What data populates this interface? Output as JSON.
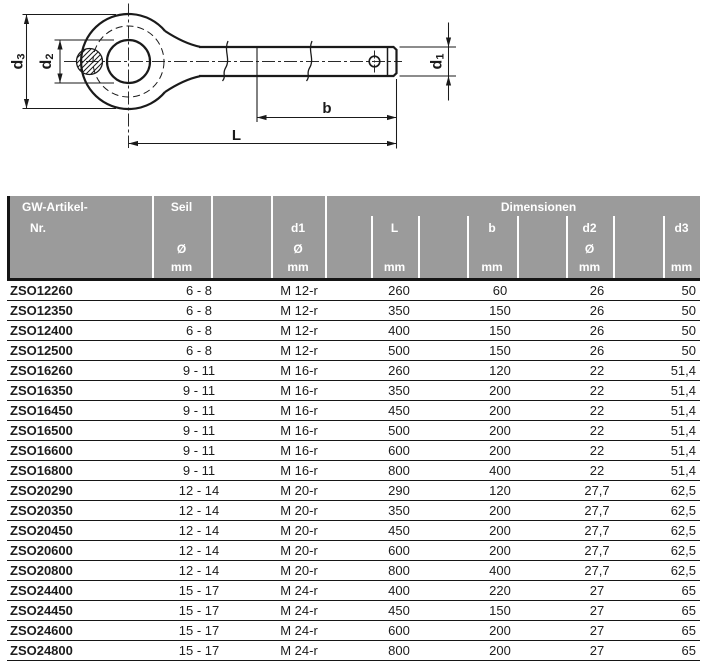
{
  "drawing": {
    "labels": {
      "d3_main": "d",
      "d3_sub": "3",
      "d2_main": "d",
      "d2_sub": "2",
      "d1_main": "d",
      "d1_sub": "1",
      "b": "b",
      "L": "L"
    }
  },
  "table": {
    "header": {
      "artikel_line1": "GW-Artikel-",
      "artikel_line2": "Nr.",
      "seil": "Seil",
      "dimensionen": "Dimensionen",
      "d1": "d1",
      "l": "L",
      "b": "b",
      "d2": "d2",
      "d3": "d3",
      "diameter": "Ø",
      "unit": "mm"
    },
    "rows": [
      [
        "ZSO12260",
        "6 - 8",
        "M 12-r",
        "260",
        "60",
        "26",
        "50"
      ],
      [
        "ZSO12350",
        "6 - 8",
        "M 12-r",
        "350",
        "150",
        "26",
        "50"
      ],
      [
        "ZSO12400",
        "6 - 8",
        "M 12-r",
        "400",
        "150",
        "26",
        "50"
      ],
      [
        "ZSO12500",
        "6 - 8",
        "M 12-r",
        "500",
        "150",
        "26",
        "50"
      ],
      [
        "ZSO16260",
        "9 - 11",
        "M 16-r",
        "260",
        "120",
        "22",
        "51,4"
      ],
      [
        "ZSO16350",
        "9 - 11",
        "M 16-r",
        "350",
        "200",
        "22",
        "51,4"
      ],
      [
        "ZSO16450",
        "9 - 11",
        "M 16-r",
        "450",
        "200",
        "22",
        "51,4"
      ],
      [
        "ZSO16500",
        "9 - 11",
        "M 16-r",
        "500",
        "200",
        "22",
        "51,4"
      ],
      [
        "ZSO16600",
        "9 - 11",
        "M 16-r",
        "600",
        "200",
        "22",
        "51,4"
      ],
      [
        "ZSO16800",
        "9 - 11",
        "M 16-r",
        "800",
        "400",
        "22",
        "51,4"
      ],
      [
        "ZSO20290",
        "12 - 14",
        "M 20-r",
        "290",
        "120",
        "27,7",
        "62,5"
      ],
      [
        "ZSO20350",
        "12 - 14",
        "M 20-r",
        "350",
        "200",
        "27,7",
        "62,5"
      ],
      [
        "ZSO20450",
        "12 - 14",
        "M 20-r",
        "450",
        "200",
        "27,7",
        "62,5"
      ],
      [
        "ZSO20600",
        "12 - 14",
        "M 20-r",
        "600",
        "200",
        "27,7",
        "62,5"
      ],
      [
        "ZSO20800",
        "12 - 14",
        "M 20-r",
        "800",
        "400",
        "27,7",
        "62,5"
      ],
      [
        "ZSO24400",
        "15 - 17",
        "M 24-r",
        "400",
        "220",
        "27",
        "65"
      ],
      [
        "ZSO24450",
        "15 - 17",
        "M 24-r",
        "450",
        "150",
        "27",
        "65"
      ],
      [
        "ZSO24600",
        "15 - 17",
        "M 24-r",
        "600",
        "200",
        "27",
        "65"
      ],
      [
        "ZSO24800",
        "15 - 17",
        "M 24-r",
        "800",
        "200",
        "27",
        "65"
      ]
    ]
  },
  "colors": {
    "header_bg": "#9b9b9b",
    "header_text": "#ffffff",
    "line_color": "#161616",
    "body_text": "#1c1c1c"
  }
}
